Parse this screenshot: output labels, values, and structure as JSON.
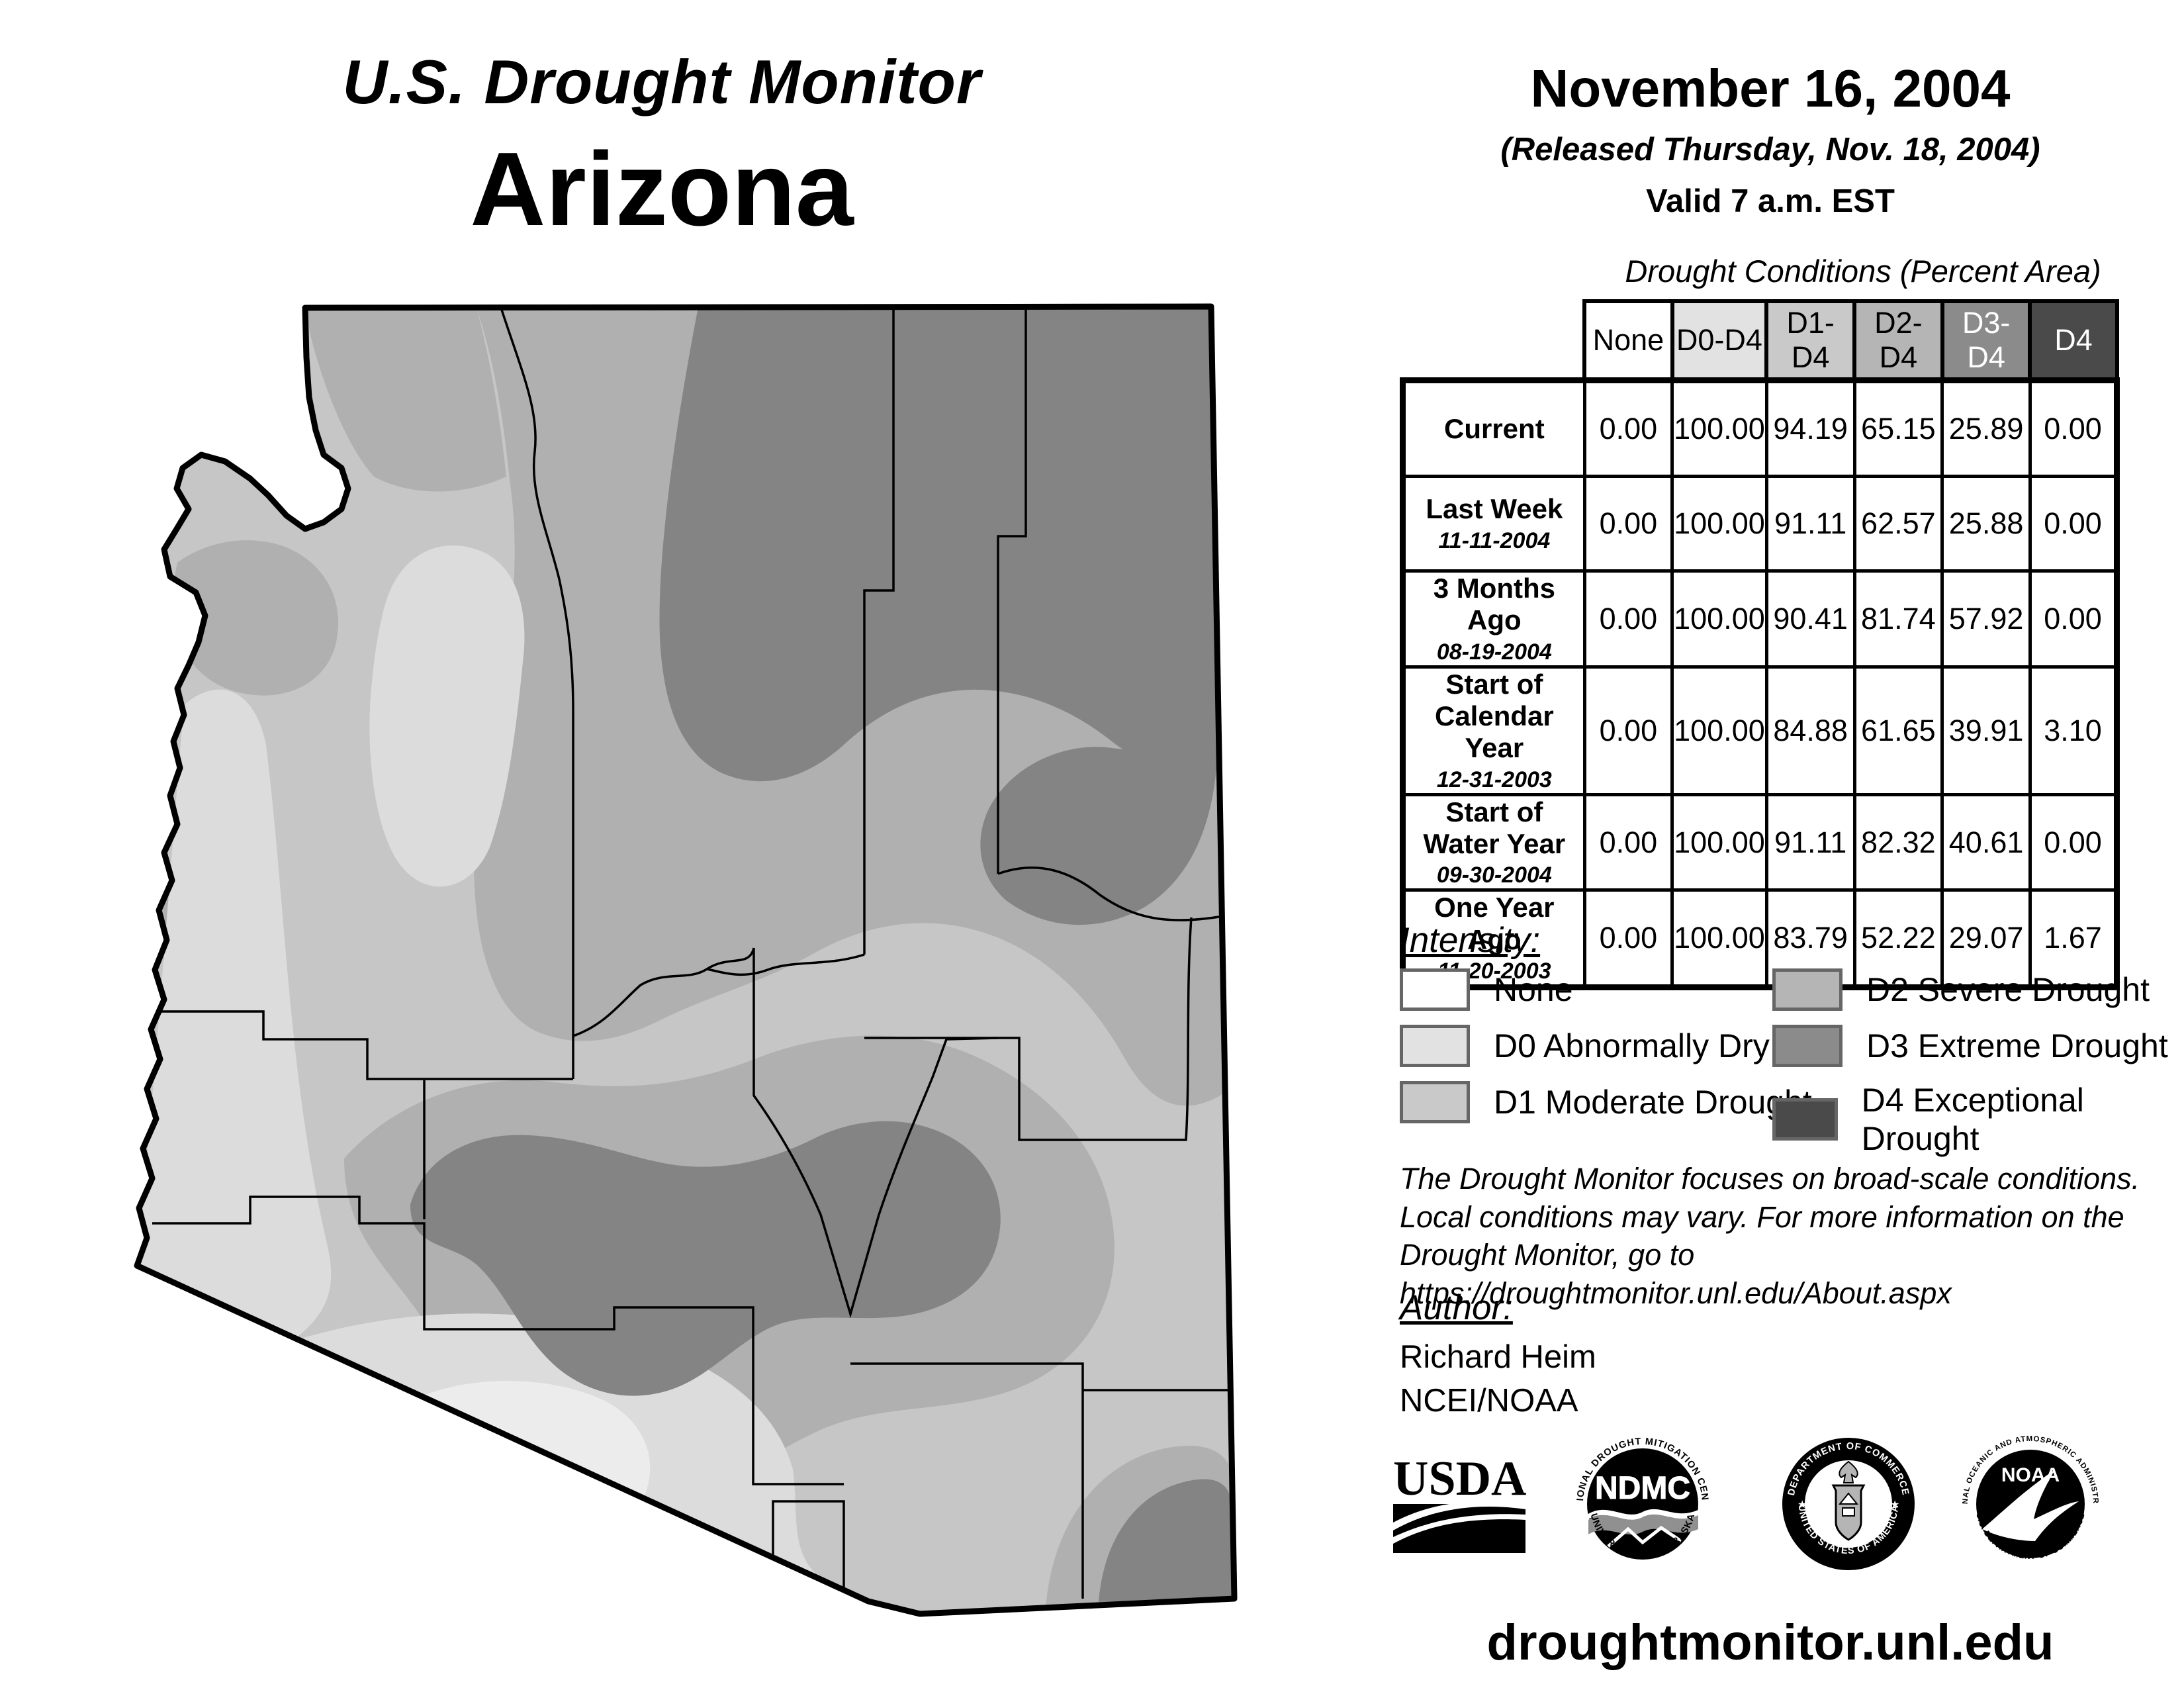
{
  "title": {
    "line1": "U.S. Drought Monitor",
    "line2": "Arizona"
  },
  "date_block": {
    "date": "November 16, 2004",
    "released": "(Released Thursday, Nov. 18, 2004)",
    "valid": "Valid 7 a.m. EST"
  },
  "table": {
    "caption": "Drought Conditions (Percent Area)",
    "columns": [
      "None",
      "D0-D4",
      "D1-D4",
      "D2-D4",
      "D3-D4",
      "D4"
    ],
    "column_colors": [
      "#ffffff",
      "#e2e2e2",
      "#c9c9c9",
      "#b5b5b5",
      "#8b8b8b",
      "#4a4a4a"
    ],
    "rows": [
      {
        "label": "Current",
        "date": "",
        "values": [
          "0.00",
          "100.00",
          "94.19",
          "65.15",
          "25.89",
          "0.00"
        ]
      },
      {
        "label": "Last Week",
        "date": "11-11-2004",
        "values": [
          "0.00",
          "100.00",
          "91.11",
          "62.57",
          "25.88",
          "0.00"
        ]
      },
      {
        "label": "3 Months Ago",
        "date": "08-19-2004",
        "values": [
          "0.00",
          "100.00",
          "90.41",
          "81.74",
          "57.92",
          "0.00"
        ]
      },
      {
        "label": "Start of Calendar Year",
        "date": "12-31-2003",
        "values": [
          "0.00",
          "100.00",
          "84.88",
          "61.65",
          "39.91",
          "3.10"
        ]
      },
      {
        "label": "Start of Water Year",
        "date": "09-30-2004",
        "values": [
          "0.00",
          "100.00",
          "91.11",
          "82.32",
          "40.61",
          "0.00"
        ]
      },
      {
        "label": "One Year Ago",
        "date": "11-20-2003",
        "values": [
          "0.00",
          "100.00",
          "83.79",
          "52.22",
          "29.07",
          "1.67"
        ]
      }
    ]
  },
  "legend": {
    "heading": "Intensity:",
    "items": [
      {
        "label": "None",
        "color": "#ffffff"
      },
      {
        "label": "D0 Abnormally Dry",
        "color": "#e2e2e2"
      },
      {
        "label": "D1 Moderate Drought",
        "color": "#c9c9c9"
      },
      {
        "label": "D2 Severe Drought",
        "color": "#b5b5b5"
      },
      {
        "label": "D3 Extreme Drought",
        "color": "#8b8b8b"
      },
      {
        "label": "D4 Exceptional Drought",
        "color": "#4a4a4a"
      }
    ]
  },
  "disclaimer": {
    "line1": "The Drought Monitor focuses on broad-scale conditions.",
    "line2": "Local conditions may vary. For more information on the",
    "line3": "Drought Monitor, go to https://droughtmonitor.unl.edu/About.aspx"
  },
  "author": {
    "heading": "Author:",
    "name": "Richard Heim",
    "org": "NCEI/NOAA"
  },
  "logos": {
    "usda": {
      "label": "USDA"
    },
    "ndmc": {
      "label": "NDMC",
      "ring_top": "NATIONAL DROUGHT MITIGATION CENTER",
      "ring_bottom": "UNIVERSITY OF NEBRASKA"
    },
    "doc": {
      "ring_top": "DEPARTMENT OF COMMERCE",
      "ring_bottom": "UNITED STATES OF AMERICA"
    },
    "noaa": {
      "label": "NOAA",
      "ring_top": "NATIONAL OCEANIC AND ATMOSPHERIC ADMINISTRATION",
      "ring_bottom": "U.S. DEPARTMENT OF COMMERCE"
    }
  },
  "footer": {
    "url": "droughtmonitor.unl.edu"
  },
  "map": {
    "state": "Arizona",
    "colors": {
      "d0_light": "#ececec",
      "d0": "#dcdcdc",
      "d1": "#c6c6c6",
      "d2": "#b0b0b0",
      "d3": "#848484"
    }
  }
}
